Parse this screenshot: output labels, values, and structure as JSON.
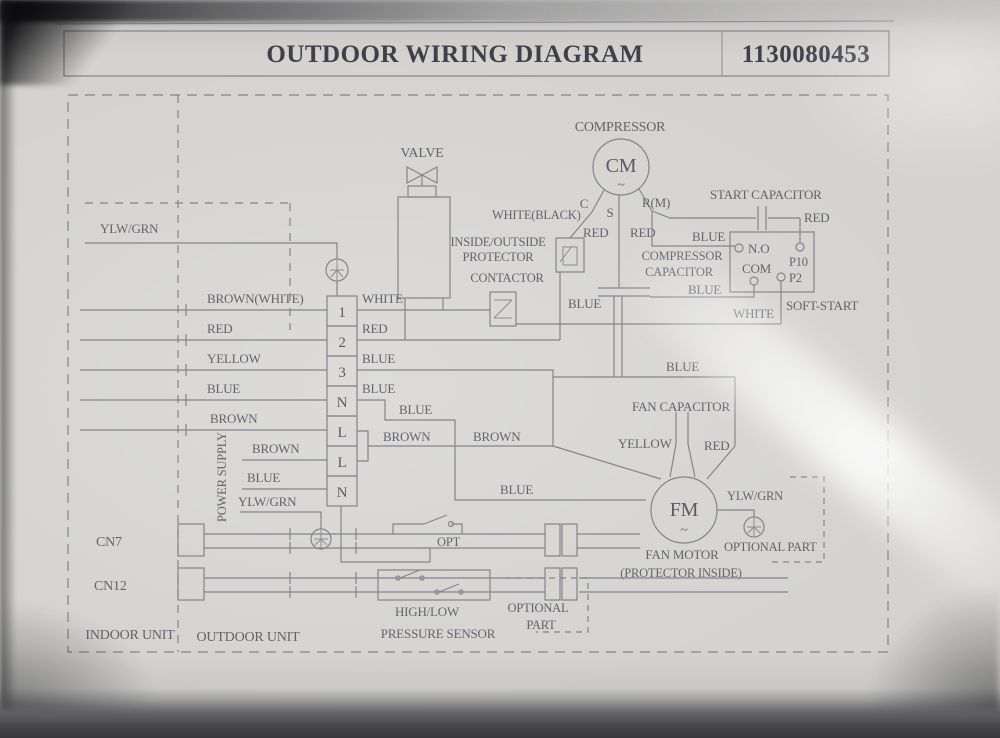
{
  "title": {
    "main": "OUTDOOR WIRING DIAGRAM",
    "number": "1130080453"
  },
  "compressor": {
    "label": "COMPRESSOR",
    "cm": "CM",
    "tilde": "~",
    "c": "C",
    "s": "S",
    "rm": "R(M)",
    "red_s": "RED",
    "red_rm": "RED",
    "white_black": "WHITE(BLACK)"
  },
  "protector": {
    "line1": "INSIDE/OUTSIDE",
    "line2": "PROTECTOR"
  },
  "contactor": {
    "label": "CONTACTOR"
  },
  "valve": {
    "label": "VALVE"
  },
  "start_capacitor": {
    "label": "START CAPACITOR",
    "red": "RED"
  },
  "soft_start": {
    "label": "SOFT-START",
    "no": "N.O",
    "com": "COM",
    "p10": "P10",
    "p2": "P2",
    "white": "WHITE",
    "blue_in": "BLUE"
  },
  "compressor_capacitor": {
    "line1": "COMPRESSOR",
    "line2": "CAPACITOR",
    "blue_lower": "BLUE",
    "blue_drop": "BLUE"
  },
  "fan": {
    "blue": "BLUE",
    "capacitor": "FAN CAPACITOR",
    "yellow": "YELLOW",
    "red": "RED",
    "fm": "FM",
    "tilde": "~",
    "motor": "FAN MOTOR",
    "protector": "(PROTECTOR INSIDE)",
    "ylwgrn": "YLW/GRN",
    "optional": "OPTIONAL PART"
  },
  "ground_top": {
    "label": "YLW/GRN"
  },
  "terminal_block": {
    "terminals": [
      "1",
      "2",
      "3",
      "N",
      "L",
      "L",
      "N"
    ]
  },
  "wires_left": {
    "w1": "BROWN(WHITE)",
    "w2": "RED",
    "w3": "YELLOW",
    "w4": "BLUE",
    "w5": "BROWN",
    "power_supply": "POWER SUPPLY",
    "w6": "BROWN",
    "w7": "BLUE",
    "w8": "YLW/GRN"
  },
  "wires_right": {
    "w1": "WHITE",
    "w2": "RED",
    "w3": "BLUE",
    "w4": "BLUE",
    "blue_n": "BLUE",
    "brown": "BROWN",
    "brown2": "BROWN",
    "blue2": "BLUE"
  },
  "bottom": {
    "cn7": "CN7",
    "cn12": "CN12",
    "opt": "OPT",
    "high_low": "HIGH/LOW",
    "pressure_sensor": "PRESSURE SENSOR",
    "optional1": "OPTIONAL",
    "optional2": "PART"
  },
  "units": {
    "indoor": "INDOOR UNIT",
    "outdoor": "OUTDOOR UNIT"
  },
  "style": {
    "paper": "#d4d3d0",
    "ink": "#6a6a73"
  }
}
